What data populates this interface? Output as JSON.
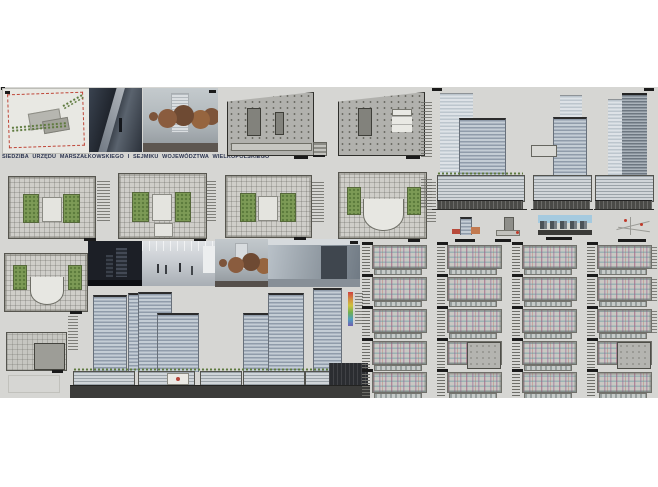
{
  "title": {
    "text": "SIEDZIBA URZĘDU MARSZAŁKOWSKIEGO I SEJMIKU WOJEWÓDZTWA WIELKOPOLSKIEGO"
  },
  "colors": {
    "page_bg": "#ffffff",
    "board_bg": "#d6d6d3",
    "title_text": "#2c3550",
    "site_boundary_red": "#bf4638",
    "courtyard_green": "#7d9a56",
    "glass_facade_dark": "#909caa",
    "glass_facade_light": "#c4cdd5",
    "tower_cap_dark": "#2c2c2c",
    "ground_band_dark": "#3c3c3a",
    "night_render_sky": "#1c1f26",
    "autumn_tree_brown": "#8a5c3e",
    "section_sky_blue": "#a5cadf",
    "plan_fill_gray": "#cfcec9",
    "parking_fill_gray": "#b1b1ad",
    "miniplan_magenta": "#985c8e",
    "miniplan_cyan": "#58949e",
    "miniplan_red": "#ba4842"
  }
}
